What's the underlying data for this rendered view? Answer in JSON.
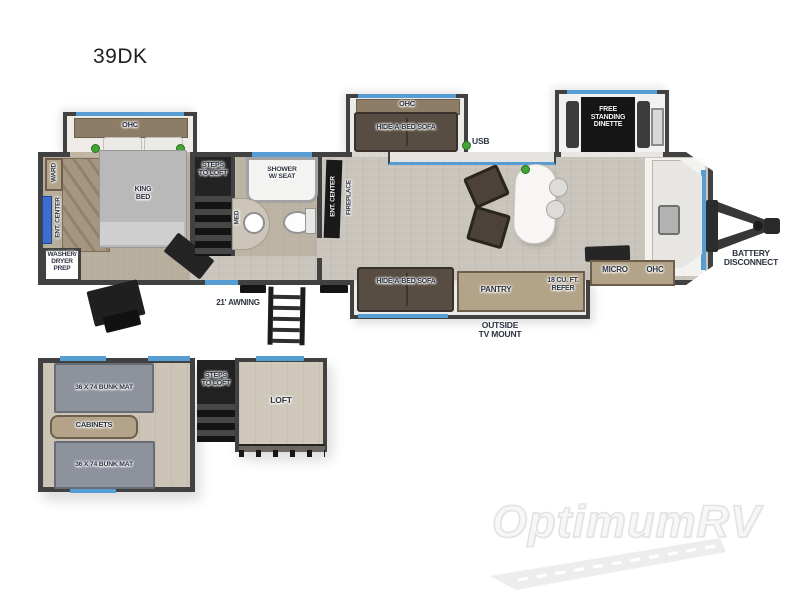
{
  "title": "39DK",
  "watermark": "OptimumRV",
  "main_floor": {
    "bedroom": {
      "ohc": "OHC",
      "king_bed": "KING BED",
      "ward": "WARD",
      "ent_center": "ENT. CENTER",
      "washer_dryer_prep": "WASHER/ DRYER PREP"
    },
    "steps": "STEPS TO LOFT",
    "bath": {
      "shower": "SHOWER W/ SEAT",
      "med": "MED"
    },
    "living": {
      "ent_center": "ENT. CENTER",
      "fireplace": "FIREPLACE",
      "ohc": "OHC",
      "hide_a_bed_sofa": "HIDE-A-BED SOFA",
      "usb": "USB",
      "dinette": "FREE STANDING DINETTE"
    },
    "kitchen": {
      "micro": "MICRO",
      "ohc": "OHC",
      "pantry": "PANTRY",
      "refer": "18 CU. FT. REFER"
    },
    "exterior": {
      "awning": "21' AWNING",
      "outside_tv_mount": "OUTSIDE TV MOUNT",
      "battery_disconnect": "BATTERY DISCONNECT",
      "hide_a_bed_sofa": "HIDE-A-BED SOFA"
    }
  },
  "loft_floor": {
    "bunk_mat_1": "36 X 74 BUNK MAT",
    "cabinets": "CABINETS",
    "bunk_mat_2": "36 X 74 BUNK MAT",
    "steps": "STEPS TO LOFT",
    "loft": "LOFT"
  },
  "colors": {
    "accent_blue": "#569dd3",
    "wall": "#414141",
    "cabinet_tan": "#b3a389",
    "sofa_brown": "#584d42",
    "indicator_green": "#43a536"
  }
}
